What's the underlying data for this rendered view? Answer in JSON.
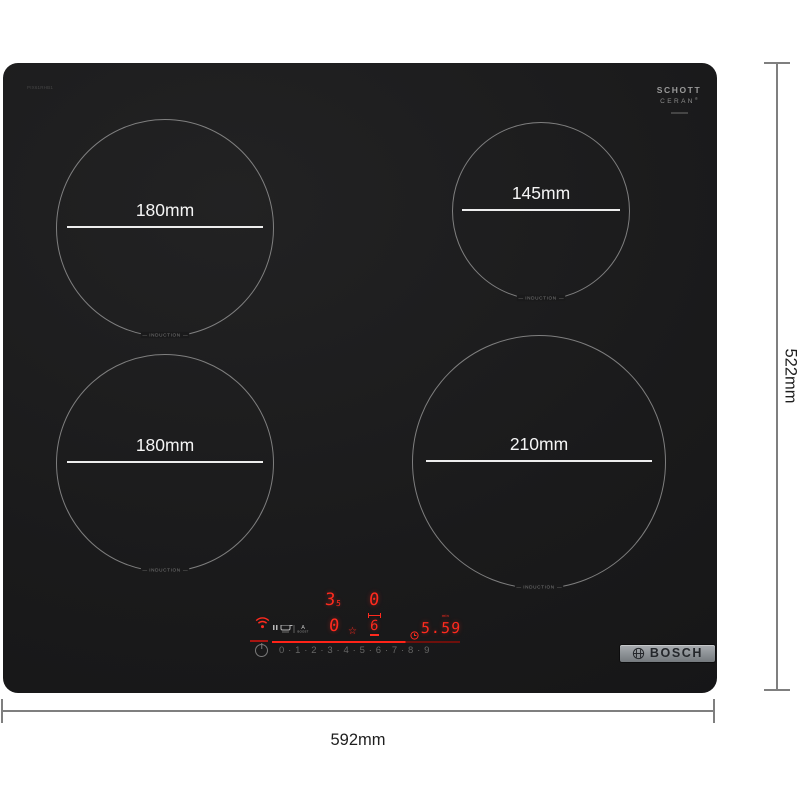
{
  "dimensions": {
    "width": "592mm",
    "height": "522mm"
  },
  "hob": {
    "model_code": "PIX61RHB1",
    "surface_color": "#1b1b1c",
    "glass_logo": {
      "line1": "SCHOTT",
      "line2": "CERAN",
      "registered": "®"
    },
    "badge_brand": "BOSCH"
  },
  "zones": [
    {
      "position": "rear-left",
      "diameter": "180mm",
      "label": "INDUCTION"
    },
    {
      "position": "rear-right",
      "diameter": "145mm",
      "label": "INDUCTION"
    },
    {
      "position": "front-left",
      "diameter": "180mm",
      "label": "INDUCTION"
    },
    {
      "position": "front-right",
      "diameter": "210mm",
      "label": "INDUCTION"
    }
  ],
  "control_panel": {
    "display_red": "#ff2a1e",
    "zone_power": {
      "rear_left_main": "3",
      "rear_left_sub": "5",
      "rear_right": "0",
      "front_left": "0",
      "front_right": "6"
    },
    "timer": {
      "value": "5.59",
      "unit": "min"
    },
    "boost": {
      "letter": "A",
      "label": "BOOST"
    },
    "star_glyph": "☆",
    "power_scale": "0 · 1 · 2 · 3 · 4 · 5 · 6 · 7 · 8 · 9"
  }
}
